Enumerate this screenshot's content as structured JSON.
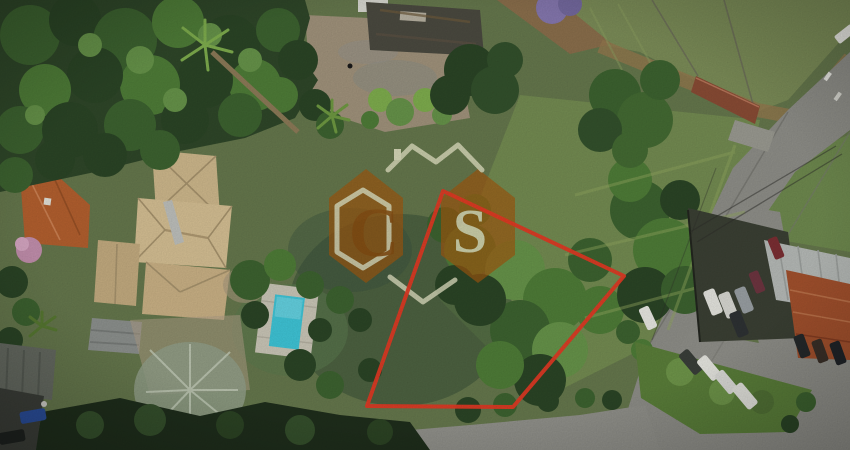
{
  "meta": {
    "kind": "aerial-drone-photo",
    "subject": "residential land lot marked for sale, outlined in red, with neighboring houses, swimming pool, roads and trees"
  },
  "watermark": {
    "letter_left": "C",
    "letter_right": "S"
  },
  "annotation": {
    "lot_outline_color": "#e23a24"
  },
  "palette": {
    "watermark_orange": "#a2590f",
    "watermark_letter_orange": "#8f4c0c",
    "watermark_cream": "#eae9cb",
    "pool_water": "#3fc6d8"
  }
}
